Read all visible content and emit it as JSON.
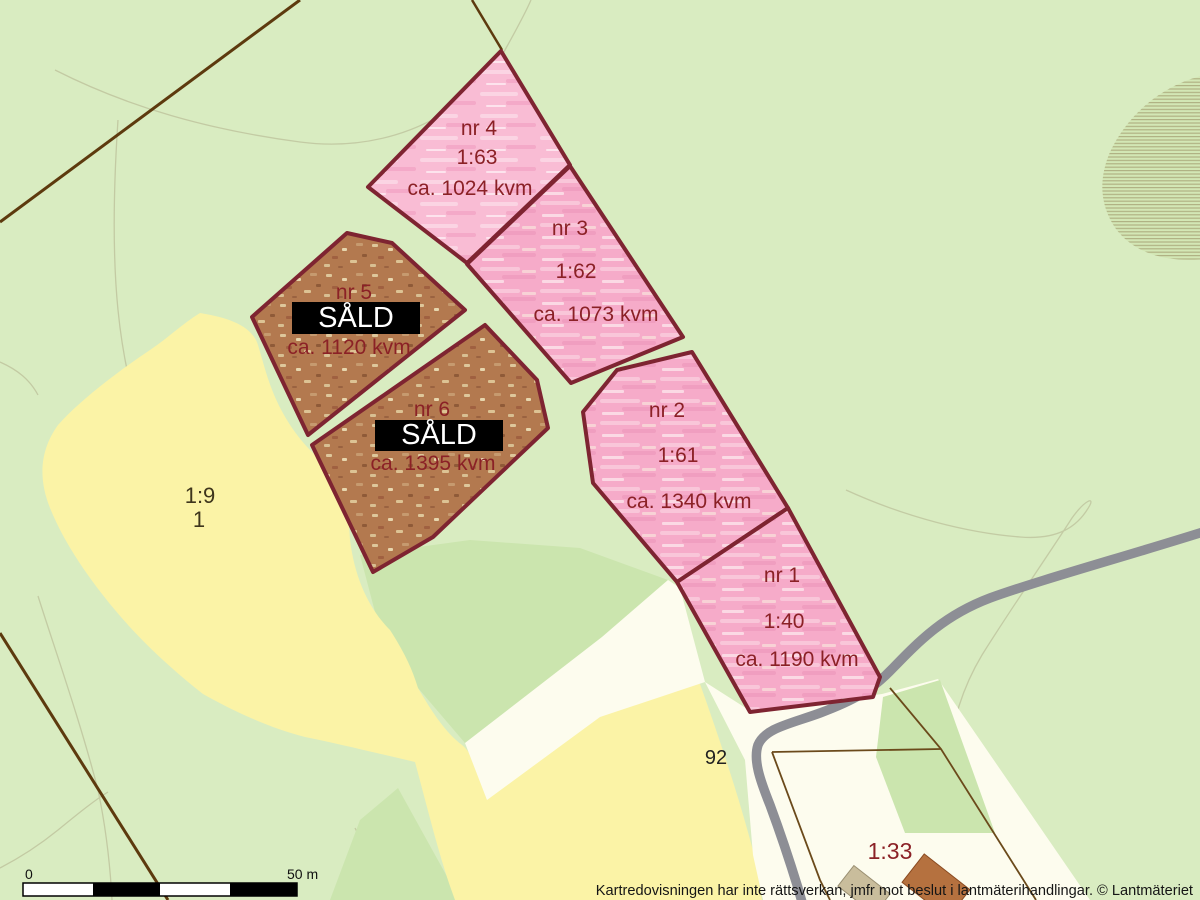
{
  "map": {
    "plots": [
      {
        "id": "nr1",
        "name": "nr 1",
        "designation": "1:40",
        "area": "ca. 1190 kvm",
        "status": "for-sale"
      },
      {
        "id": "nr2",
        "name": "nr 2",
        "designation": "1:61",
        "area": "ca. 1340 kvm",
        "status": "for-sale"
      },
      {
        "id": "nr3",
        "name": "nr 3",
        "designation": "1:62",
        "area": "ca. 1073 kvm",
        "status": "for-sale"
      },
      {
        "id": "nr4",
        "name": "nr 4",
        "designation": "1:63",
        "area": "ca. 1024 kvm",
        "status": "for-sale"
      },
      {
        "id": "nr5",
        "name": "nr 5",
        "designation": "",
        "area": "ca. 1120 kvm",
        "status": "SÅLD"
      },
      {
        "id": "nr6",
        "name": "nr 6",
        "designation": "",
        "area": "ca. 1395 kvm",
        "status": "SÅLD"
      }
    ],
    "sold_label": "SÅLD",
    "labels": {
      "field": "1:9",
      "field_sub": "1",
      "road_number": "92",
      "property": "1:33"
    },
    "scalebar": {
      "start": "0",
      "end": "50 m"
    },
    "attribution": "Kartredovisningen har inte rättsverkan, jmfr mot beslut i lantmäterihandlingar. © Lantmäteriet",
    "colors": {
      "background_green": "#d9ecc1",
      "deep_green": "#cbe5ae",
      "field_yellow": "#fbf3a6",
      "open_land_white": "#fdfcee",
      "plot_pink": "#f6abc9",
      "plot_pink_light": "#f9bcd4",
      "sold_brown": "#b3794f",
      "plot_border": "#7e2431",
      "label_red": "#8b2126",
      "road_gray": "#8d8e95",
      "sold_badge_bg": "#000000",
      "sold_badge_text": "#ffffff"
    }
  }
}
